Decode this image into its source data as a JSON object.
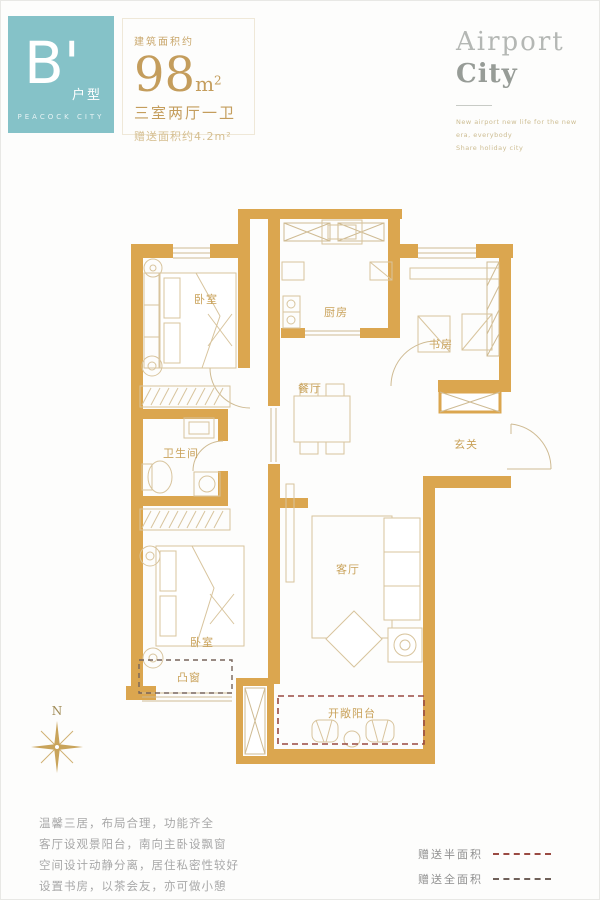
{
  "badge": {
    "letter": "B'",
    "type_label": "户型",
    "subtitle": "PEACOCK CITY"
  },
  "header": {
    "area_prefix": "建筑面积约",
    "area_value": "98",
    "area_unit": "m",
    "area_sup": "2",
    "layout_text": "三室两厅一卫",
    "bonus_text": "赠送面积约4.2m²"
  },
  "brand": {
    "name_line1": "Airport",
    "name_line2": "City",
    "tagline_line1": "New airport new life for the new era, everybody",
    "tagline_line2": "Share holiday city"
  },
  "plan": {
    "rooms": {
      "bedroom1": "卧室",
      "kitchen": "厨房",
      "study": "书房",
      "dining": "餐厅",
      "bathroom": "卫生间",
      "hallway": "玄关",
      "bedroom2": "卧室",
      "living": "客厅",
      "bay_window": "凸窗",
      "balcony": "开敞阳台"
    }
  },
  "compass": {
    "north_label": "N"
  },
  "description": {
    "lines": [
      "温馨三居，布局合理，功能齐全",
      "客厅设观景阳台，南向主卧设飘窗",
      "空间设计动静分离，居住私密性较好",
      "设置书房，以茶会友，亦可做小憩"
    ]
  },
  "legend": {
    "items": [
      {
        "label": "赠送半面积",
        "color": "#9A4A42"
      },
      {
        "label": "赠送全面积",
        "color": "#6F6059"
      }
    ]
  },
  "colors": {
    "wall": "#DBA64F",
    "teal": "#85C2C8",
    "gold_text": "#C49D5C",
    "furniture": "#D8C49D"
  }
}
